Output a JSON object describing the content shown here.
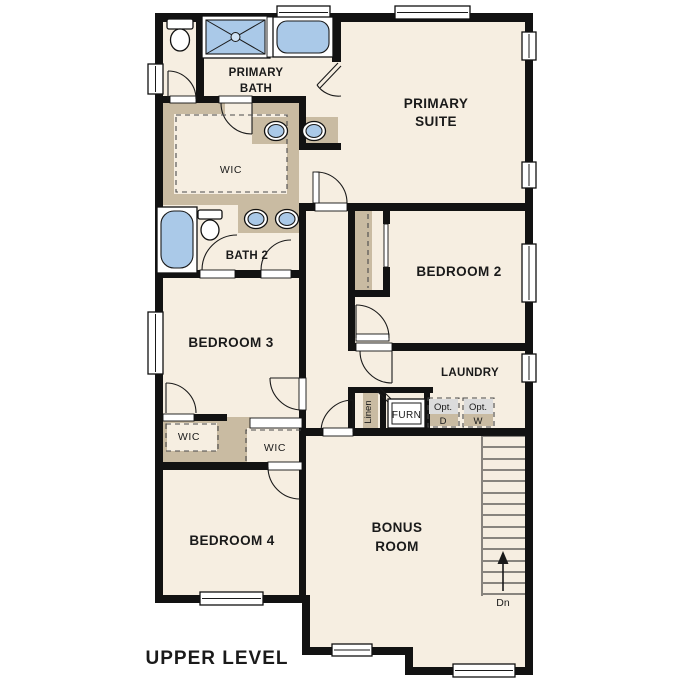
{
  "plan": {
    "title": "UPPER LEVEL",
    "type": "floor-plan",
    "labels": {
      "primary_bath_1": "PRIMARY",
      "primary_bath_2": "BATH",
      "primary_suite_1": "PRIMARY",
      "primary_suite_2": "SUITE",
      "wic_primary": "WIC",
      "wic_bedroom3": "WIC",
      "wic_bedroom4": "WIC",
      "bath2": "BATH 2",
      "bedroom2": "BEDROOM 2",
      "bedroom3": "BEDROOM 3",
      "bedroom4": "BEDROOM 4",
      "laundry": "LAUNDRY",
      "bonus_1": "BONUS",
      "bonus_2": "ROOM",
      "linen": "Linen",
      "furnace": "FURN",
      "opt_dryer_1": "Opt.",
      "opt_dryer_2": "D",
      "opt_washer_1": "Opt.",
      "opt_washer_2": "W",
      "stairs_down": "Dn"
    },
    "fixtures": [
      "toilet",
      "shower",
      "bathtub",
      "double-vanity-sinks",
      "optional-dryer",
      "optional-washer",
      "furnace",
      "linen-closet",
      "stairs-down-arrow"
    ],
    "colors": {
      "wall": "#121212",
      "floor": "#f6eee1",
      "closet_wall_tan": "#c9bba2",
      "fixture_blue": "#aac9e8",
      "appliance_gray": "#dcdcdc",
      "background": "#ffffff"
    }
  }
}
